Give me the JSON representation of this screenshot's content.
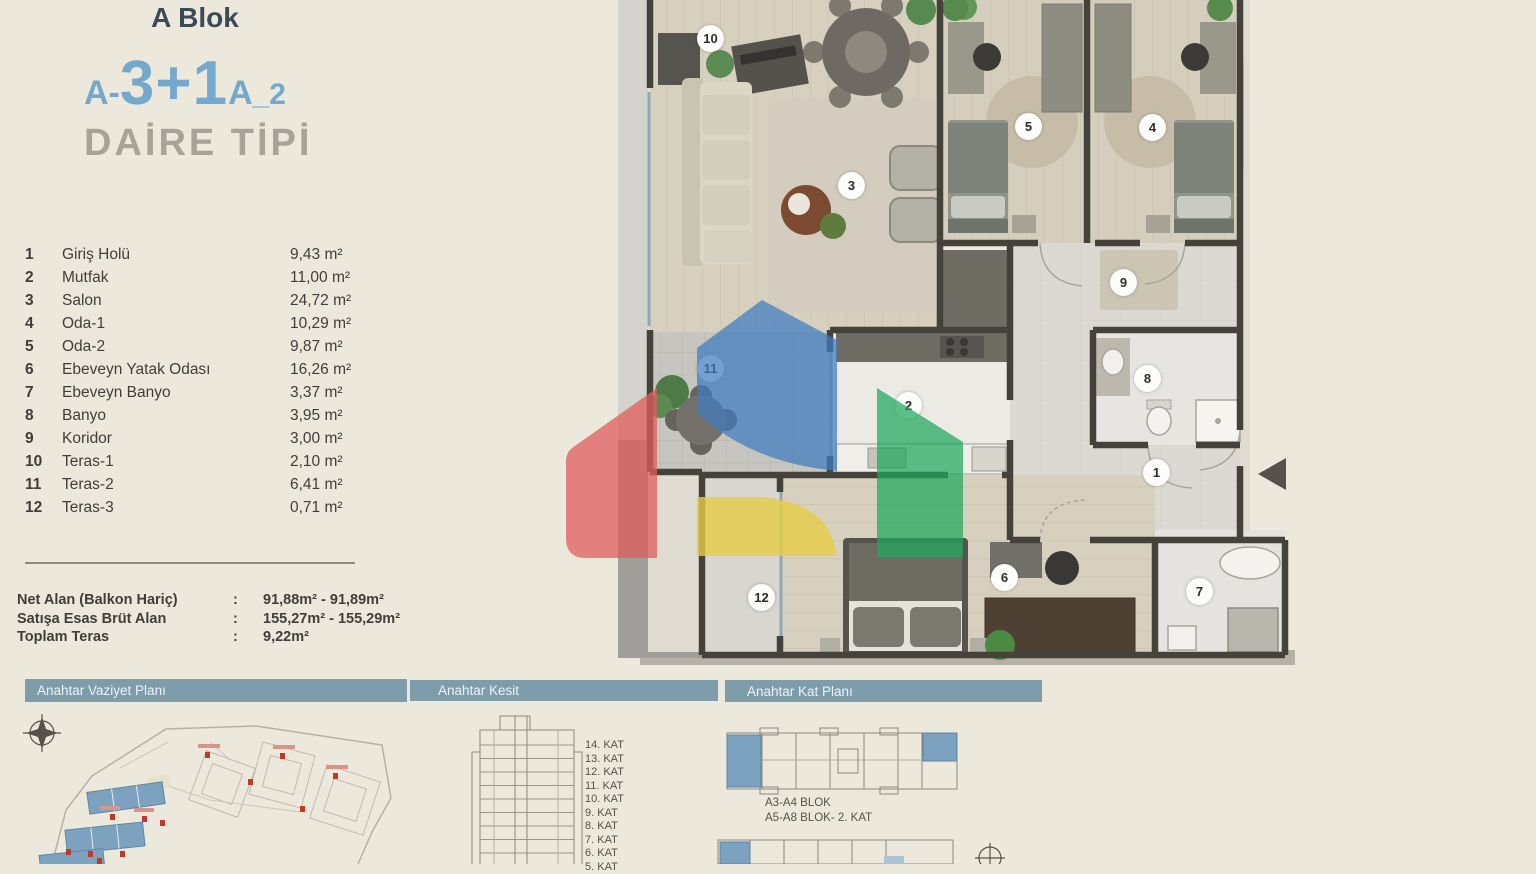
{
  "colors": {
    "bg": "#ece8dc",
    "accent_blue": "#74a9cd",
    "navy": "#3b4a56",
    "muted_gray": "#a7a398",
    "bar_bg": "#7e9dab",
    "text": "#3f3e3a",
    "watermark_red": "#e05c5c",
    "watermark_blue": "#3f7cc0",
    "watermark_yellow": "#e6cc45",
    "watermark_green": "#1fa75c"
  },
  "header": {
    "block": "A Blok",
    "type_prefix": "A-",
    "type_main": "3+1",
    "type_suffix_a": "A",
    "type_suffix_n": "_2",
    "subtitle": "DAİRE TİPİ"
  },
  "rooms": [
    {
      "no": "1",
      "name": "Giriş Holü",
      "area": "9,43 m²"
    },
    {
      "no": "2",
      "name": "Mutfak",
      "area": "11,00 m²"
    },
    {
      "no": "3",
      "name": "Salon",
      "area": "24,72 m²"
    },
    {
      "no": "4",
      "name": "Oda-1",
      "area": "10,29 m²"
    },
    {
      "no": "5",
      "name": "Oda-2",
      "area": "9,87 m²"
    },
    {
      "no": "6",
      "name": "Ebeveyn Yatak Odası",
      "area": "16,26 m²"
    },
    {
      "no": "7",
      "name": "Ebeveyn Banyo",
      "area": "3,37 m²"
    },
    {
      "no": "8",
      "name": "Banyo",
      "area": "3,95 m²"
    },
    {
      "no": "9",
      "name": "Koridor",
      "area": "3,00 m²"
    },
    {
      "no": "10",
      "name": "Teras-1",
      "area": "2,10 m²"
    },
    {
      "no": "11",
      "name": "Teras-2",
      "area": "6,41 m²"
    },
    {
      "no": "12",
      "name": "Teras-3",
      "area": "0,71 m²"
    }
  ],
  "summary": {
    "rows": [
      {
        "label": "Net Alan (Balkon Hariç)",
        "sep": ":",
        "value": "91,88m² - 91,89m²"
      },
      {
        "label": "Satışa Esas Brüt Alan",
        "sep": ":",
        "value": "155,27m² - 155,29m²"
      },
      {
        "label": "Toplam Teras",
        "sep": ":",
        "value": "9,22m²"
      }
    ]
  },
  "section_bars": {
    "site": "Anahtar Vaziyet Planı",
    "kesit": "Anahtar Kesit",
    "kat": "Anahtar Kat Planı"
  },
  "kesit": {
    "floors": [
      "14. KAT",
      "13. KAT",
      "12. KAT",
      "11. KAT",
      "10. KAT",
      "9. KAT",
      "8. KAT",
      "7. KAT",
      "6. KAT",
      "5. KAT"
    ]
  },
  "katplan": {
    "line1": "A3-A4 BLOK",
    "line2": "A5-A8 BLOK- 2. KAT"
  },
  "plan_markers": [
    "10",
    "5",
    "4",
    "3",
    "9",
    "11",
    "8",
    "2",
    "1",
    "6",
    "12",
    "7"
  ]
}
